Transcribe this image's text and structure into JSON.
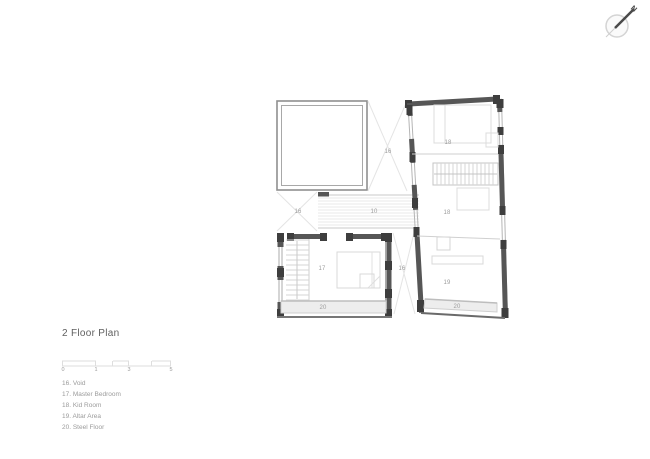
{
  "compass": {
    "label": "N"
  },
  "title": "2 Floor Plan",
  "scale_bar": {
    "ticks": [
      "0",
      "1",
      "3",
      "5"
    ]
  },
  "legend": {
    "items": [
      "16. Void",
      "17. Master Bedroom",
      "18. Kid Room",
      "19. Altar Area",
      "20. Steel Floor"
    ]
  },
  "plan": {
    "labels": {
      "void_upper": "16",
      "void_lower_left": "16",
      "void_middle": "16",
      "bridge": "10",
      "master_bedroom": "17",
      "kid_room_upper": "18",
      "kid_room_lower": "18",
      "altar_area": "19",
      "steel_floor_left": "20",
      "steel_floor_right": "20"
    }
  }
}
